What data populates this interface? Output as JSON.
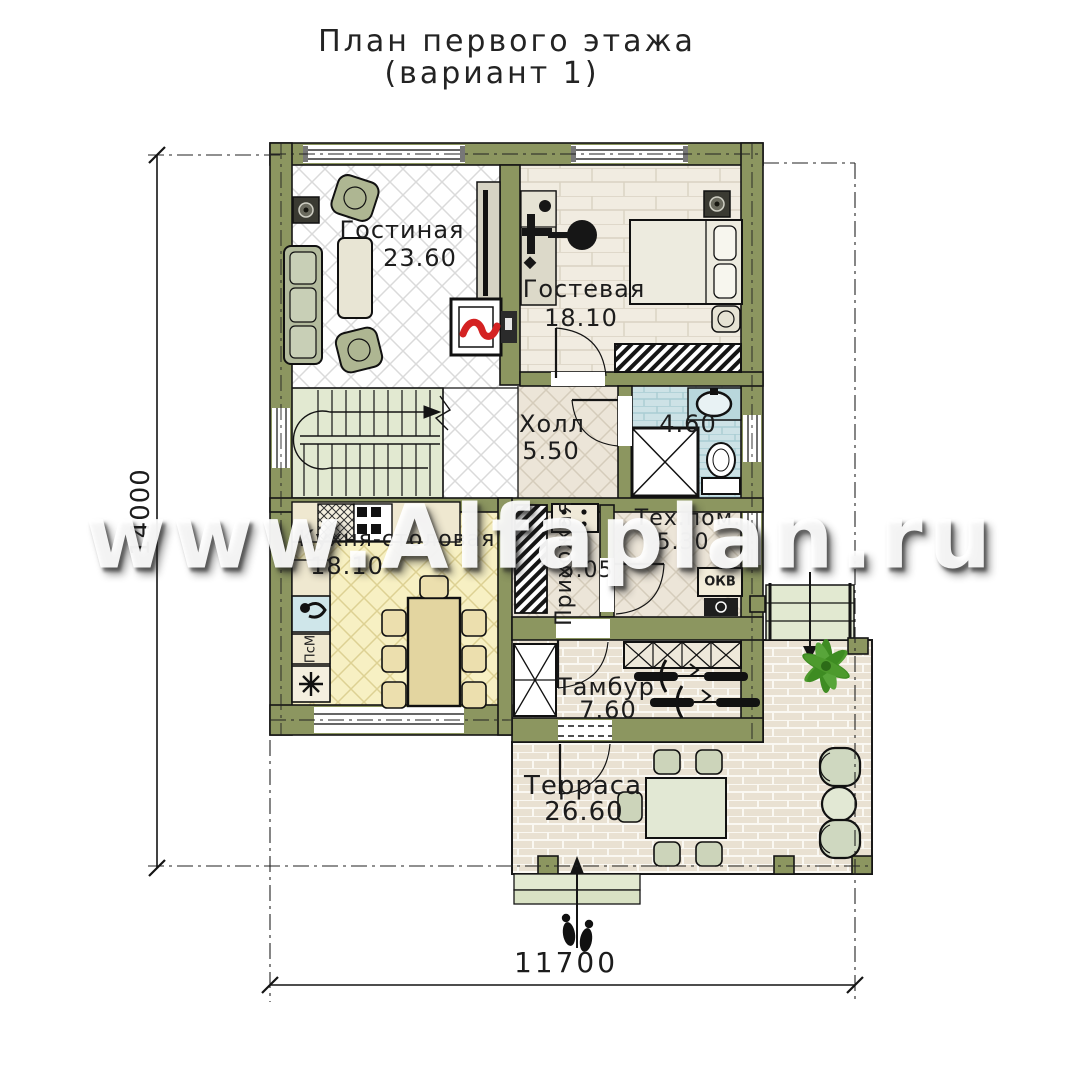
{
  "title": {
    "line1": "План первого этажа",
    "line2": "(вариант 1)"
  },
  "watermark": "www.Alfaplan.ru",
  "dimensions": {
    "horizontal": "11700",
    "vertical": "14000"
  },
  "rooms": {
    "living": {
      "name": "Гостиная",
      "area": "23.60"
    },
    "guest": {
      "name": "Гостевая",
      "area": "18.10"
    },
    "hall": {
      "name": "Холл",
      "area": "5.50"
    },
    "bathroom": {
      "area": "4.60"
    },
    "kitchen": {
      "name": "Кухня-столовая",
      "area": "18.10"
    },
    "hallway": {
      "name": "Прихожая",
      "area": "5.05"
    },
    "tech": {
      "name": "Тех.пом.",
      "area": "5.30"
    },
    "vestibule": {
      "name": "Тамбур",
      "area": "7.60"
    },
    "terrace": {
      "name": "Терраса",
      "area": "26.60"
    }
  },
  "appliances": {
    "washer": "ПсМ",
    "boiler": "ОКВ"
  },
  "colors": {
    "wall": "#8c9660",
    "flame": "#d42222",
    "plant": "#3e8c22",
    "bath_floor": "#cde2e6",
    "kitchen_floor": "#f7f0c3",
    "stairs_floor": "#e2e9d1",
    "watermark_text": "#ffffff"
  }
}
